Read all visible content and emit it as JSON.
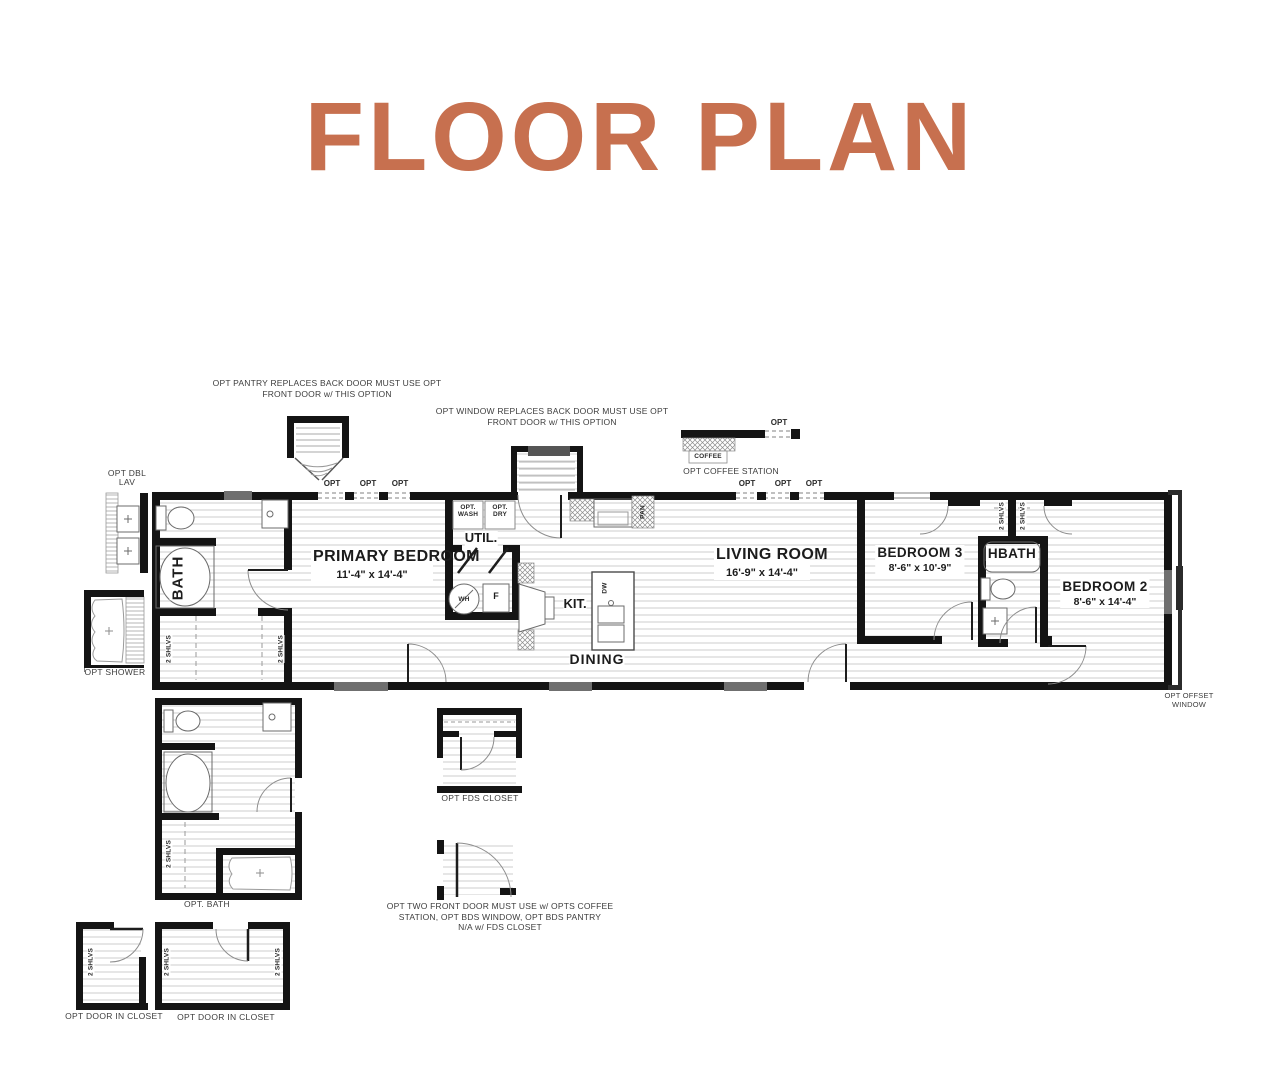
{
  "title": "FLOOR PLAN",
  "accent_color": "#C7704F",
  "notes": {
    "pantry_l1": "OPT PANTRY REPLACES BACK DOOR MUST USE OPT",
    "pantry_l2": "FRONT DOOR w/ THIS OPTION",
    "window_l1": "OPT WINDOW REPLACES BACK DOOR MUST USE OPT",
    "window_l2": "FRONT DOOR w/ THIS OPTION",
    "coffee_station": "OPT COFFEE STATION",
    "front_door_l1": "OPT TWO FRONT DOOR MUST USE w/ OPTS COFFEE",
    "front_door_l2": "STATION, OPT BDS WINDOW, OPT BDS PANTRY",
    "front_door_l3": "N/A w/ FDS CLOSET",
    "offset_window_l1": "OPT OFFSET",
    "offset_window_l2": "WINDOW"
  },
  "rooms": {
    "primary_bedroom": {
      "name": "PRIMARY BEDROOM",
      "dims": "11'-4\" x  14'-4\""
    },
    "bath": {
      "name": "BATH"
    },
    "util": {
      "name": "UTIL."
    },
    "kitchen": {
      "name": "KIT."
    },
    "dining": {
      "name": "DINING"
    },
    "living_room": {
      "name": "LIVING ROOM",
      "dims": "16'-9\" x  14'-4\""
    },
    "bedroom3": {
      "name": "BEDROOM 3",
      "dims": "8'-6\" x  10'-9\""
    },
    "hbath": {
      "name": "HBATH"
    },
    "bedroom2": {
      "name": "BEDROOM 2",
      "dims": "8'-6\" x  14'-4\""
    }
  },
  "labels": {
    "opt": "OPT",
    "shelves": "2 SHLVS",
    "coffee": "COFFEE",
    "pan": "PAN",
    "dw": "DW",
    "wh": "WH",
    "furnace": "F",
    "opt_wash": "OPT. WASH",
    "opt_dry": "OPT. DRY",
    "dbl_lav": "OPT DBL LAV",
    "opt_shower": "OPT SHOWER",
    "opt_bath": "OPT. BATH",
    "fds_closet": "OPT FDS CLOSET",
    "door_in_closet": "OPT DOOR IN CLOSET"
  }
}
